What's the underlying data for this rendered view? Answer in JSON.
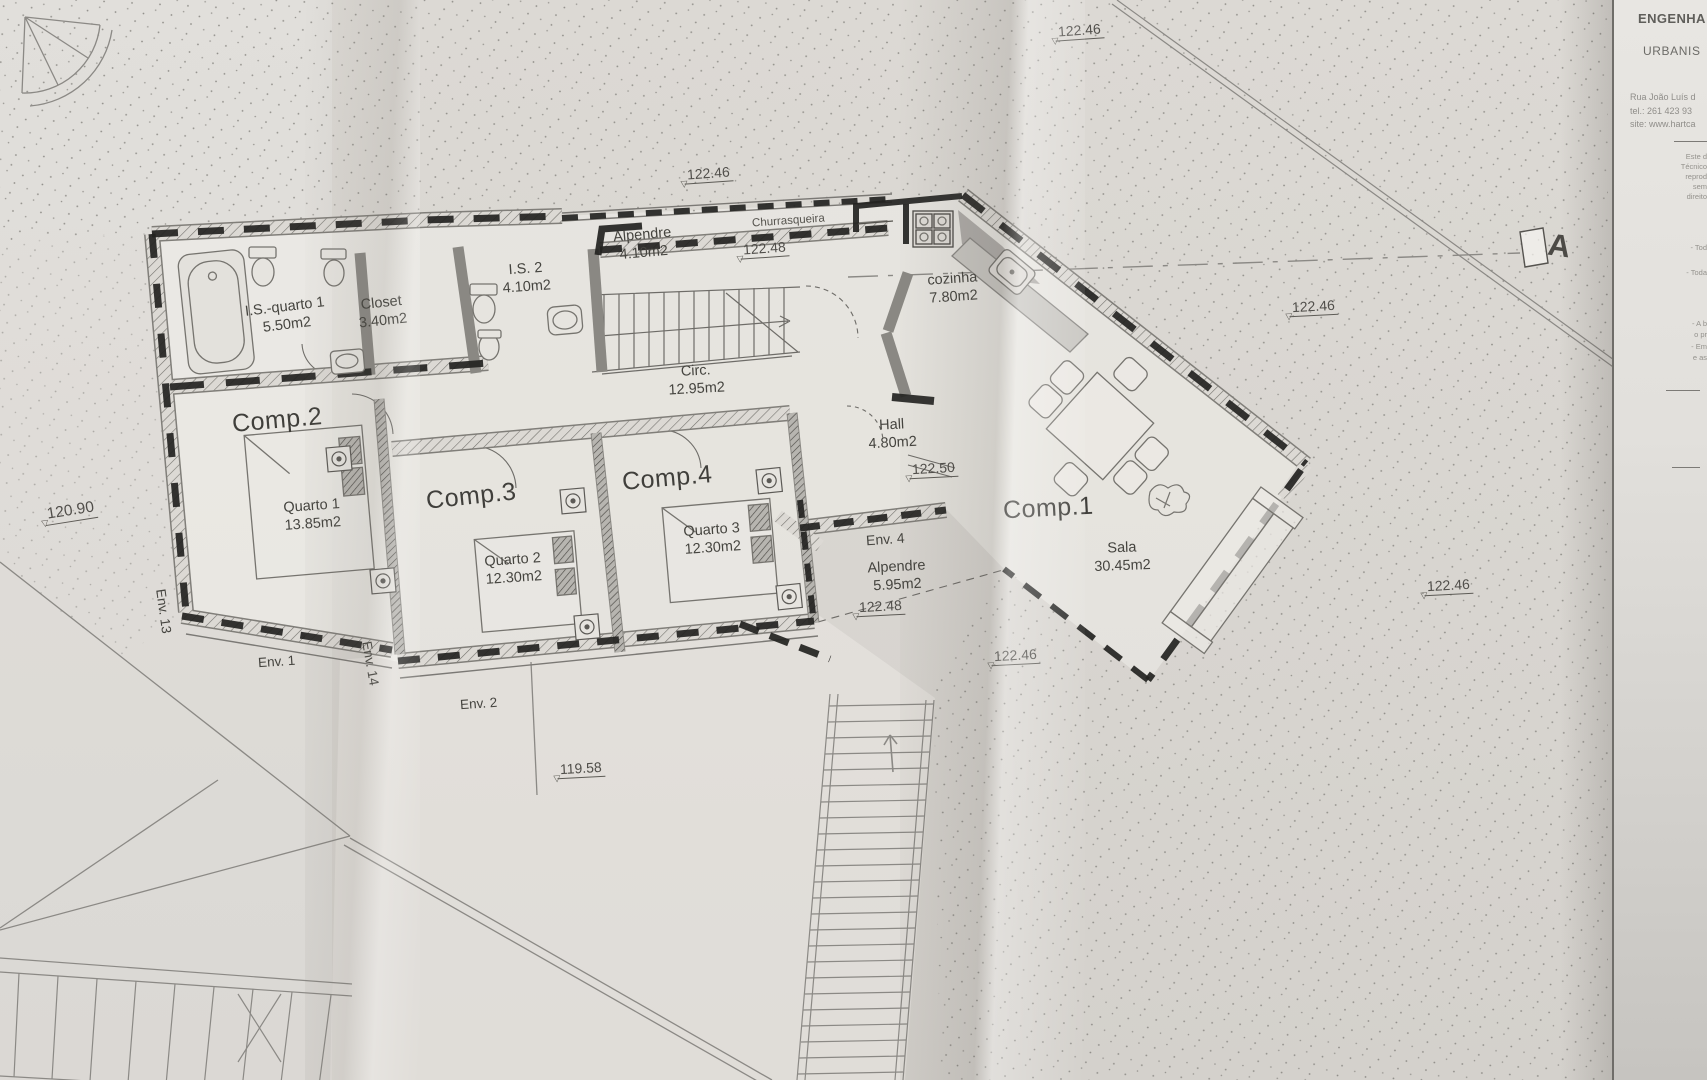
{
  "icons": {
    "level_triangle": "▽"
  },
  "plan": {
    "rooms": {
      "comp1": {
        "name": "Comp.1",
        "space": "Sala",
        "area": "30.45m2"
      },
      "comp2": {
        "name": "Comp.2",
        "space": "Quarto 1",
        "area": "13.85m2"
      },
      "comp3": {
        "name": "Comp.3",
        "space": "Quarto 2",
        "area": "12.30m2"
      },
      "comp4": {
        "name": "Comp.4",
        "space": "Quarto 3",
        "area": "12.30m2"
      },
      "is_quarto1": {
        "space": "I.S.-quarto 1",
        "area": "5.50m2"
      },
      "closet": {
        "space": "Closet",
        "area": "3.40m2"
      },
      "is2": {
        "space": "I.S. 2",
        "area": "4.10m2"
      },
      "alpendre_top": {
        "space": "Alpendre",
        "area": "4.10m2"
      },
      "churrasqueira": {
        "space": "Churrasqueira"
      },
      "cozinha": {
        "space": "cozinha",
        "area": "7.80m2"
      },
      "circ": {
        "space": "Circ.",
        "area": "12.95m2"
      },
      "hall": {
        "space": "Hall",
        "area": "4.80m2"
      },
      "env4": {
        "label": "Env. 4",
        "space": "Alpendre",
        "area": "5.95m2"
      }
    },
    "envelopes": {
      "env1": "Env. 1",
      "env2": "Env. 2",
      "env13": "Env. 13",
      "env14": "Env. 14"
    },
    "levels": {
      "top_center": "122.46",
      "upper_mid": "122.46",
      "alpendre": "122.48",
      "hall": "122.50",
      "env4_floor": "122.48",
      "below_env4": "122.46",
      "right_mid": "122.46",
      "bottom_right": "122.46",
      "left": "120.90",
      "bottom": "119.58"
    },
    "section_marker": "A"
  },
  "title_block": {
    "heading": "ENGENHA",
    "subheading": "URBANIS",
    "address": "Rua João Luís d",
    "phone": "tel.: 261 423 93",
    "website": "site: www.hartca",
    "disclaimer": [
      "Este d",
      "Técnico",
      "reprod",
      "sem",
      "direito"
    ],
    "notes": [
      "- Tod",
      "- Toda"
    ],
    "notes2": [
      "- A b",
      "o pr",
      "- Em",
      "e as"
    ]
  }
}
